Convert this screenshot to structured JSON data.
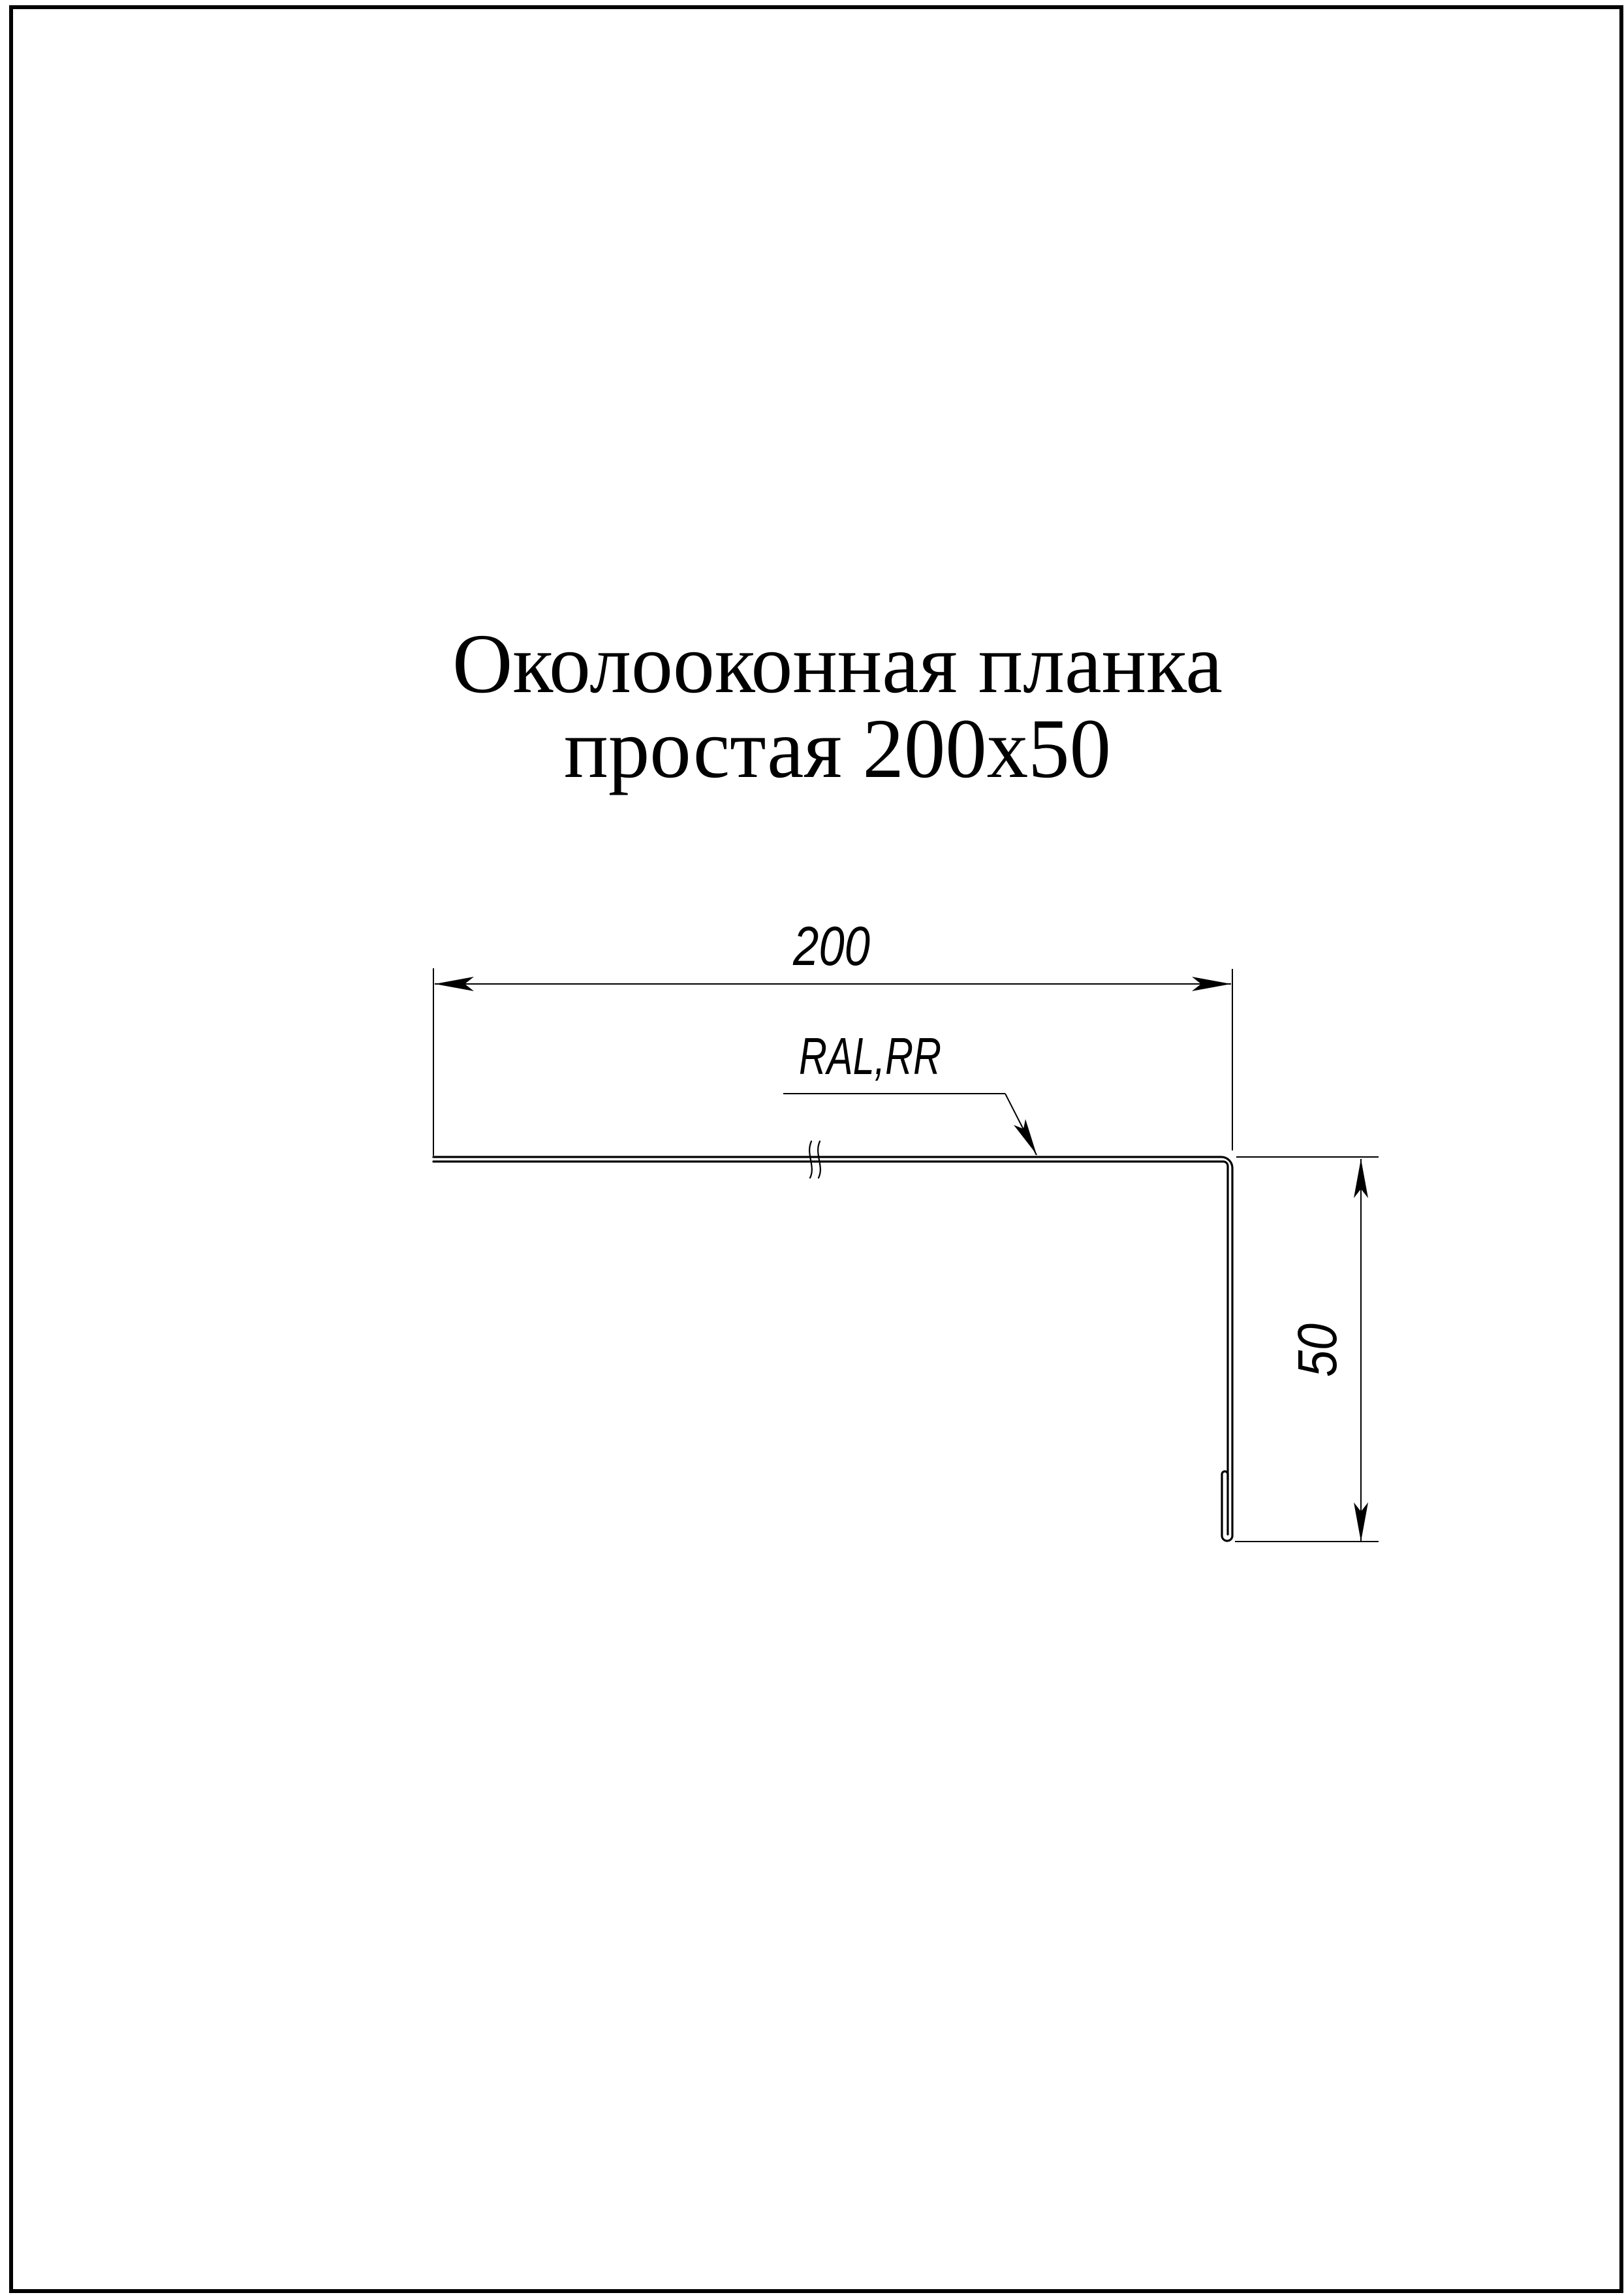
{
  "page": {
    "background_color": "#ffffff",
    "line_color": "#000000"
  },
  "title": {
    "line1": "Околооконная планка",
    "line2": "простая 200х50"
  },
  "dimensions": {
    "width": "200",
    "height": "50"
  },
  "labels": {
    "coating": "RAL,RR"
  },
  "drawing": {
    "type": "sheet-metal-profile-section",
    "product": "window trim strip, simple, 200x50",
    "features": [
      "horizontal flange 200",
      "vertical flange 50",
      "hemmed bottom edge",
      "break mark on long flange"
    ]
  }
}
